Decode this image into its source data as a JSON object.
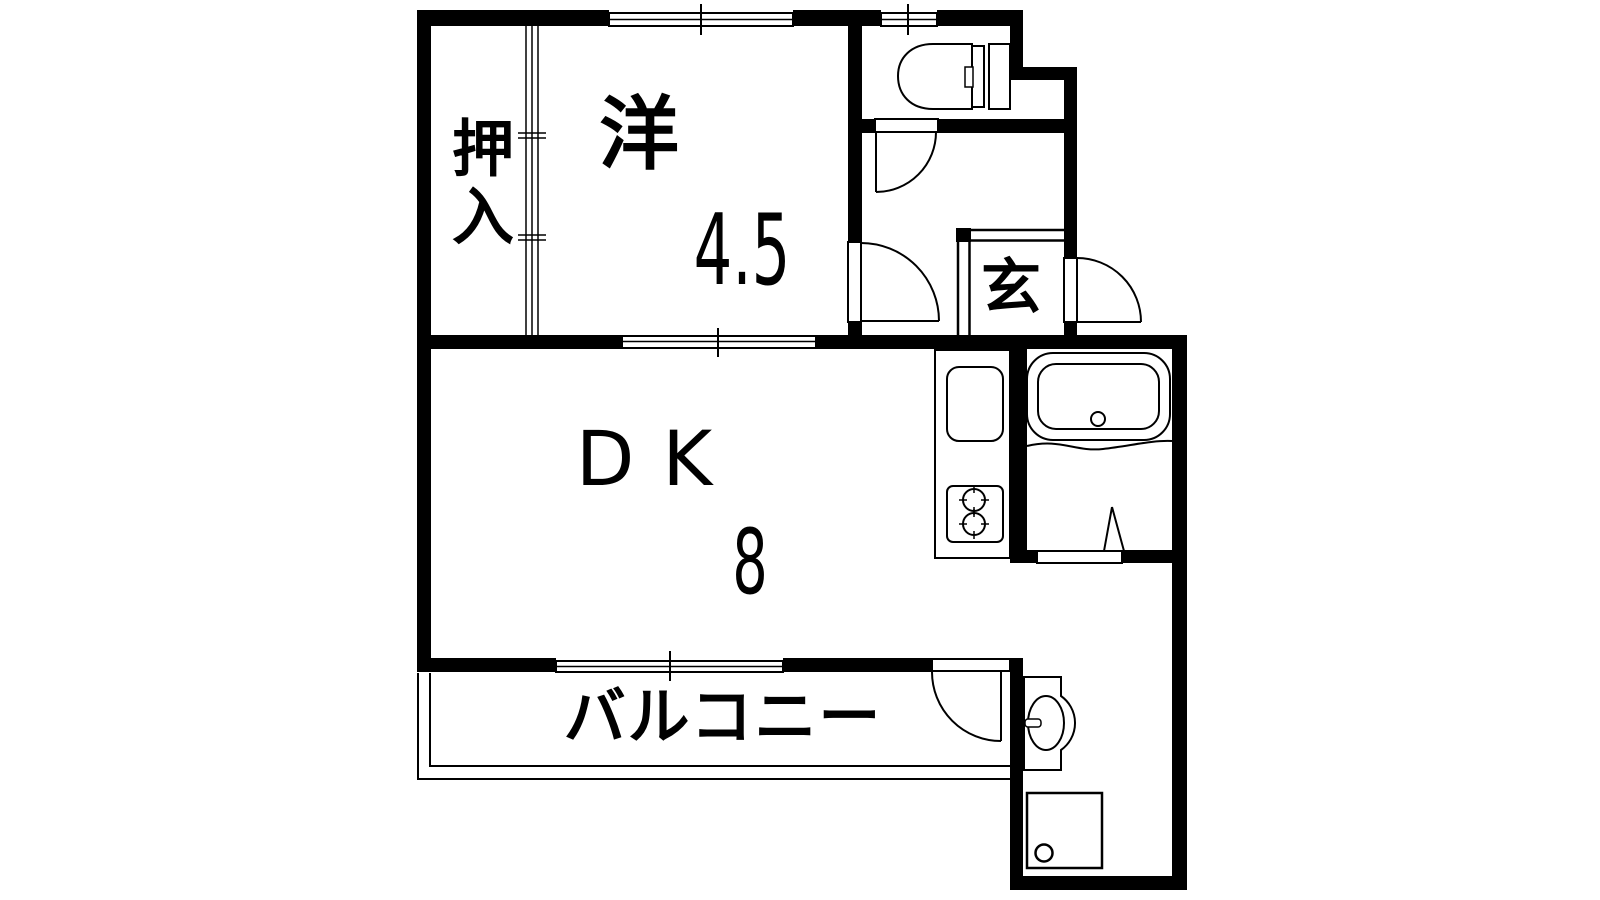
{
  "figure": {
    "kind": "apartment-floor-plan",
    "colors": {
      "wall": "#000000",
      "background": "#ffffff",
      "line": "#000000"
    }
  },
  "rooms": {
    "closet": {
      "label": "押入"
    },
    "western_room": {
      "label": "洋",
      "size": "4.5"
    },
    "dining_kitchen": {
      "label": "DK",
      "size": "8"
    },
    "entrance": {
      "label": "玄"
    },
    "balcony": {
      "label": "バルコニー"
    }
  },
  "fixtures": {
    "toilet": "toilet-with-tank",
    "bathtub": "bathtub-with-drain",
    "kitchen_sink": "kitchen-sink",
    "stove": "two-burner-stove",
    "washbasin": "washbasin",
    "washing_machine_pan": "washing-machine-pan"
  },
  "openings": {
    "western_window": "sliding-window",
    "toilet_window": "sliding-window",
    "western_dk": "sliding-door",
    "balcony_window": "sliding-window",
    "closet_partition": "sliding-fusuma",
    "western_door": "hinged-door",
    "toilet_door": "hinged-door",
    "entrance_door": "hinged-door-outward",
    "laundry_door": "hinged-door",
    "bath_door": "folding-door",
    "genkan_step": "step-edge"
  }
}
